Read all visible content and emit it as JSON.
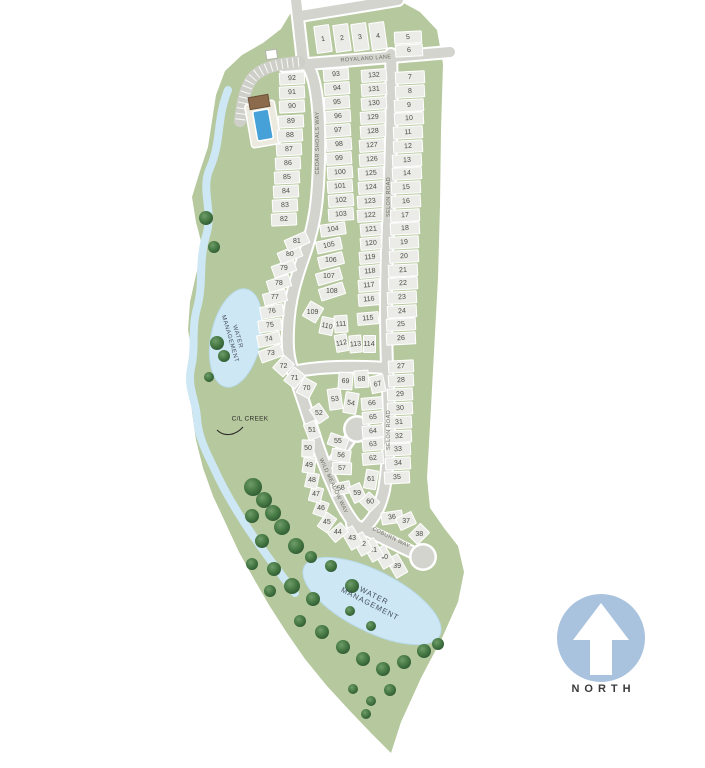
{
  "site_plan": {
    "title": "Community site plan with numbered lots",
    "streets": [
      {
        "name": "ROYALAND LANE"
      },
      {
        "name": "CEDAR SHOALS WAY"
      },
      {
        "name": "SELON ROAD"
      },
      {
        "name": "SELON ROAD"
      },
      {
        "name": "WILD MEADOW WAY"
      },
      {
        "name": "COBURN WAY"
      }
    ],
    "water_labels": [
      {
        "text": "WATER\nMANAGEMENT"
      },
      {
        "text": "WATER\nMANAGEMENT"
      }
    ],
    "creek_label": {
      "text": "C/L CREEK"
    },
    "north": {
      "label": "NORTH"
    },
    "colors": {
      "site_green": "#b6c89d",
      "road_gray": "#d4d4cf",
      "water_blue": "#cde7f4",
      "pool_blue": "#45a1d8",
      "north_blue": "#a9c3de",
      "tree_green": "#3f6f41",
      "building_brown": "#8b6b4b"
    },
    "lots": [
      [
        "1",
        323,
        39,
        16,
        28,
        -8
      ],
      [
        "2",
        342,
        38,
        16,
        28,
        -8
      ],
      [
        "3",
        360,
        37,
        16,
        28,
        -8
      ],
      [
        "4",
        378,
        36,
        16,
        28,
        -8
      ],
      [
        "5",
        408,
        37,
        28,
        13,
        -3
      ],
      [
        "6",
        409,
        50,
        28,
        13,
        -3
      ],
      [
        "7",
        410,
        77,
        30,
        13,
        -3
      ],
      [
        "8",
        410,
        91,
        30,
        13,
        -3
      ],
      [
        "9",
        409,
        105,
        30,
        13,
        -3
      ],
      [
        "10",
        409,
        118,
        30,
        13,
        -3
      ],
      [
        "11",
        408,
        132,
        30,
        13,
        -3
      ],
      [
        "12",
        408,
        146,
        30,
        13,
        -3
      ],
      [
        "13",
        407,
        160,
        30,
        13,
        -3
      ],
      [
        "14",
        407,
        173,
        30,
        13,
        -3
      ],
      [
        "15",
        406,
        187,
        30,
        13,
        -3
      ],
      [
        "16",
        406,
        201,
        30,
        13,
        -3
      ],
      [
        "17",
        405,
        215,
        30,
        13,
        -3
      ],
      [
        "18",
        405,
        228,
        30,
        13,
        -3
      ],
      [
        "19",
        404,
        242,
        30,
        13,
        -3
      ],
      [
        "20",
        404,
        256,
        30,
        13,
        -3
      ],
      [
        "21",
        403,
        270,
        30,
        13,
        -3
      ],
      [
        "22",
        403,
        283,
        30,
        13,
        -3
      ],
      [
        "23",
        402,
        297,
        30,
        13,
        -3
      ],
      [
        "24",
        402,
        311,
        30,
        13,
        -3
      ],
      [
        "25",
        401,
        324,
        30,
        13,
        -3
      ],
      [
        "26",
        401,
        338,
        30,
        13,
        -3
      ],
      [
        "27",
        401,
        366,
        26,
        13,
        -3
      ],
      [
        "28",
        401,
        380,
        26,
        13,
        -3
      ],
      [
        "29",
        400,
        394,
        26,
        13,
        -3
      ],
      [
        "30",
        400,
        408,
        26,
        13,
        -3
      ],
      [
        "31",
        399,
        422,
        26,
        13,
        -3
      ],
      [
        "32",
        399,
        436,
        26,
        13,
        -3
      ],
      [
        "33",
        398,
        449,
        26,
        13,
        -3
      ],
      [
        "34",
        398,
        463,
        26,
        13,
        -3
      ],
      [
        "35",
        397,
        477,
        26,
        13,
        -3
      ],
      [
        "36",
        392,
        517,
        22,
        13,
        -8
      ],
      [
        "37",
        406,
        521,
        18,
        14,
        -25
      ],
      [
        "38",
        419,
        534,
        18,
        14,
        -45
      ],
      [
        "39",
        397,
        566,
        14,
        22,
        -30
      ],
      [
        "40",
        384,
        557,
        14,
        22,
        -30
      ],
      [
        "41",
        373,
        550,
        14,
        22,
        -30
      ],
      [
        "42",
        362,
        544,
        14,
        22,
        -30
      ],
      [
        "43",
        352,
        538,
        14,
        22,
        -30
      ],
      [
        "44",
        338,
        532,
        18,
        13,
        -40
      ],
      [
        "45",
        327,
        522,
        18,
        13,
        -55
      ],
      [
        "46",
        321,
        508,
        16,
        13,
        -70
      ],
      [
        "47",
        316,
        494,
        16,
        13,
        -75
      ],
      [
        "48",
        312,
        480,
        16,
        13,
        -78
      ],
      [
        "49",
        309,
        465,
        16,
        13,
        -82
      ],
      [
        "50",
        308,
        448,
        18,
        13,
        -88
      ],
      [
        "51",
        312,
        430,
        18,
        13,
        68
      ],
      [
        "52",
        319,
        413,
        18,
        13,
        55
      ],
      [
        "53",
        335,
        399,
        14,
        22,
        -8
      ],
      [
        "54",
        351,
        403,
        14,
        22,
        10
      ],
      [
        "55",
        338,
        441,
        20,
        13,
        20
      ],
      [
        "56",
        341,
        455,
        20,
        13,
        8
      ],
      [
        "57",
        342,
        468,
        20,
        13,
        2
      ],
      [
        "58",
        341,
        488,
        20,
        13,
        -12
      ],
      [
        "59",
        357,
        493,
        14,
        18,
        -25
      ],
      [
        "60",
        369,
        502,
        15,
        16,
        -45
      ],
      [
        "61",
        371,
        479,
        20,
        13,
        -80
      ],
      [
        "62",
        373,
        458,
        22,
        13,
        -5
      ],
      [
        "63",
        373,
        444,
        22,
        13,
        -5
      ],
      [
        "64",
        373,
        431,
        22,
        13,
        -5
      ],
      [
        "65",
        373,
        417,
        22,
        13,
        -5
      ],
      [
        "66",
        372,
        403,
        22,
        13,
        -5
      ],
      [
        "67",
        377,
        384,
        15,
        18,
        -12
      ],
      [
        "68",
        361,
        379,
        15,
        18,
        -4
      ],
      [
        "69",
        345,
        381,
        15,
        18,
        4
      ],
      [
        "70",
        306,
        388,
        15,
        18,
        28
      ],
      [
        "71",
        294,
        378,
        15,
        18,
        38
      ],
      [
        "72",
        283,
        366,
        15,
        18,
        42
      ],
      [
        "73",
        271,
        353,
        24,
        13,
        -20
      ],
      [
        "74",
        269,
        339,
        24,
        13,
        -12
      ],
      [
        "75",
        270,
        325,
        24,
        13,
        -8
      ],
      [
        "76",
        272,
        311,
        24,
        13,
        -10
      ],
      [
        "77",
        275,
        297,
        24,
        13,
        -14
      ],
      [
        "78",
        279,
        283,
        24,
        13,
        -18
      ],
      [
        "79",
        284,
        268,
        24,
        13,
        -20
      ],
      [
        "80",
        290,
        254,
        24,
        13,
        -22
      ],
      [
        "81",
        297,
        241,
        24,
        13,
        -24
      ],
      [
        "82",
        284,
        219,
        26,
        13,
        -3
      ],
      [
        "83",
        285,
        205,
        26,
        13,
        -3
      ],
      [
        "84",
        286,
        191,
        26,
        13,
        -3
      ],
      [
        "85",
        287,
        177,
        26,
        13,
        -3
      ],
      [
        "86",
        288,
        163,
        26,
        13,
        -3
      ],
      [
        "87",
        289,
        149,
        26,
        13,
        -3
      ],
      [
        "88",
        290,
        135,
        26,
        13,
        -3
      ],
      [
        "89",
        291,
        121,
        26,
        13,
        -3
      ],
      [
        "90",
        292,
        106,
        26,
        13,
        -3
      ],
      [
        "91",
        292,
        92,
        26,
        13,
        -3
      ],
      [
        "92",
        292,
        78,
        26,
        13,
        -3
      ],
      [
        "93",
        336,
        74,
        26,
        13,
        -4
      ],
      [
        "94",
        337,
        88,
        26,
        13,
        -4
      ],
      [
        "95",
        337,
        102,
        26,
        13,
        -4
      ],
      [
        "96",
        338,
        116,
        26,
        13,
        -4
      ],
      [
        "97",
        338,
        130,
        26,
        13,
        -4
      ],
      [
        "98",
        339,
        144,
        26,
        13,
        -4
      ],
      [
        "99",
        339,
        158,
        26,
        13,
        -4
      ],
      [
        "100",
        340,
        172,
        26,
        13,
        -4
      ],
      [
        "101",
        340,
        186,
        26,
        13,
        -4
      ],
      [
        "102",
        341,
        200,
        26,
        13,
        -4
      ],
      [
        "103",
        341,
        214,
        26,
        13,
        -4
      ],
      [
        "104",
        333,
        229,
        26,
        13,
        -8
      ],
      [
        "105",
        329,
        245,
        26,
        13,
        -12
      ],
      [
        "106",
        331,
        260,
        26,
        13,
        -14
      ],
      [
        "107",
        329,
        276,
        26,
        13,
        -16
      ],
      [
        "108",
        332,
        291,
        26,
        13,
        -18
      ],
      [
        "109",
        313,
        312,
        16,
        18,
        30
      ],
      [
        "110",
        327,
        326,
        14,
        18,
        12
      ],
      [
        "111",
        341,
        324,
        14,
        18,
        -4
      ],
      [
        "112",
        341,
        343,
        13,
        18,
        -10
      ],
      [
        "113",
        355,
        344,
        13,
        18,
        -5
      ],
      [
        "114",
        369,
        344,
        13,
        18,
        0
      ],
      [
        "115",
        368,
        318,
        22,
        13,
        -5
      ],
      [
        "116",
        369,
        299,
        22,
        13,
        -5
      ],
      [
        "117",
        369,
        285,
        22,
        13,
        -5
      ],
      [
        "118",
        370,
        271,
        22,
        13,
        -5
      ],
      [
        "119",
        370,
        257,
        22,
        13,
        -5
      ],
      [
        "120",
        371,
        243,
        22,
        13,
        -5
      ],
      [
        "121",
        371,
        229,
        22,
        13,
        -5
      ],
      [
        "122",
        370,
        215,
        26,
        13,
        -4
      ],
      [
        "123",
        370,
        201,
        26,
        13,
        -4
      ],
      [
        "124",
        371,
        187,
        26,
        13,
        -4
      ],
      [
        "125",
        371,
        173,
        26,
        13,
        -4
      ],
      [
        "126",
        372,
        159,
        26,
        13,
        -4
      ],
      [
        "127",
        372,
        145,
        26,
        13,
        -4
      ],
      [
        "128",
        373,
        131,
        26,
        13,
        -4
      ],
      [
        "129",
        373,
        117,
        26,
        13,
        -4
      ],
      [
        "130",
        374,
        103,
        26,
        13,
        -4
      ],
      [
        "131",
        374,
        89,
        26,
        13,
        -4
      ],
      [
        "132",
        374,
        75,
        26,
        13,
        -4
      ]
    ],
    "trees": [
      [
        206,
        218,
        7
      ],
      [
        214,
        247,
        6
      ],
      [
        217,
        343,
        7
      ],
      [
        224,
        356,
        6
      ],
      [
        209,
        377,
        5
      ],
      [
        253,
        487,
        9
      ],
      [
        264,
        500,
        8
      ],
      [
        273,
        513,
        8
      ],
      [
        252,
        516,
        7
      ],
      [
        282,
        527,
        8
      ],
      [
        262,
        541,
        7
      ],
      [
        296,
        546,
        8
      ],
      [
        311,
        557,
        6
      ],
      [
        252,
        564,
        6
      ],
      [
        274,
        569,
        7
      ],
      [
        331,
        566,
        6
      ],
      [
        292,
        586,
        8
      ],
      [
        313,
        599,
        7
      ],
      [
        270,
        591,
        6
      ],
      [
        352,
        586,
        7
      ],
      [
        300,
        621,
        6
      ],
      [
        322,
        632,
        7
      ],
      [
        343,
        647,
        7
      ],
      [
        363,
        659,
        7
      ],
      [
        383,
        669,
        7
      ],
      [
        404,
        662,
        7
      ],
      [
        424,
        651,
        7
      ],
      [
        350,
        611,
        5
      ],
      [
        371,
        626,
        5
      ],
      [
        390,
        690,
        6
      ],
      [
        371,
        701,
        5
      ],
      [
        353,
        689,
        5
      ],
      [
        438,
        644,
        6
      ],
      [
        366,
        714,
        5
      ]
    ]
  }
}
